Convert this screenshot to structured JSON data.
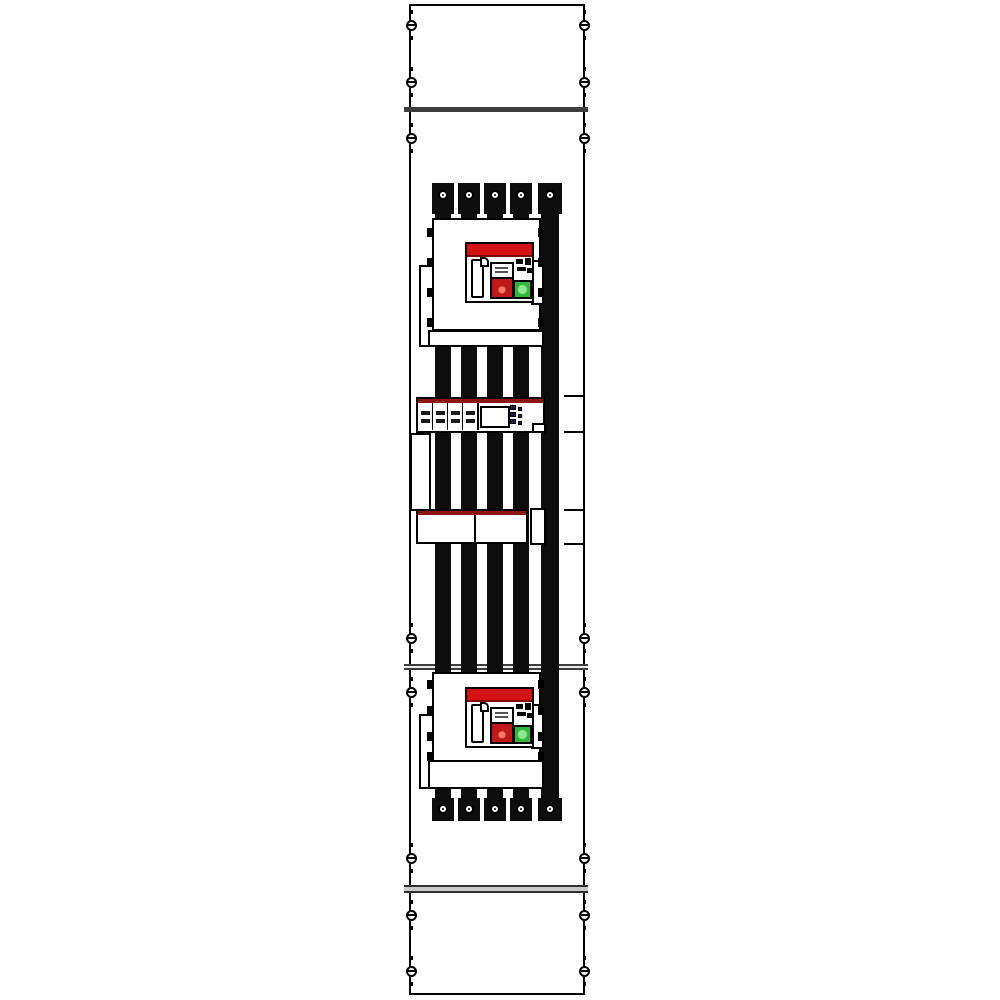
{
  "colors": {
    "c-outline": "#000000",
    "c-panel-bg": "#ffffff",
    "c-busbar": "#0d0d0d",
    "c-red-bar": "#d41414",
    "c-red-bar-edge": "#7d0a0a",
    "c-toggle-red": "#c01818",
    "c-toggle-red-hi": "#ef7d66",
    "c-green": "#2eb83c",
    "c-green-hi": "#8ee88e",
    "c-strip-red": "#8c1414",
    "c-navy": "#1c1c5a",
    "c-divider": "#3d3d3d",
    "c-divider-light": "#c9c9c9"
  },
  "panel": {
    "sections": [
      {
        "name": "top-cover"
      },
      {
        "name": "main-device-field"
      },
      {
        "name": "lower-device-field"
      },
      {
        "name": "bottom-cover"
      }
    ],
    "dividers_y": [
      107,
      664,
      885
    ]
  },
  "screws": {
    "cols_x": [
      411,
      584
    ],
    "rows_y": [
      25,
      82,
      138,
      638,
      692,
      858,
      915,
      971
    ]
  },
  "busbars": {
    "count": 5,
    "top": 190,
    "bottom": 810,
    "bars": [
      {
        "x": 435,
        "w": 16
      },
      {
        "x": 461,
        "w": 16
      },
      {
        "x": 487,
        "w": 16
      },
      {
        "x": 513,
        "w": 16
      },
      {
        "x": 541,
        "w": 18
      }
    ],
    "terminal_rows": [
      {
        "y": 183,
        "h": 31,
        "screw_y": 195
      },
      {
        "y": 798,
        "h": 23,
        "screw_y": 809
      }
    ]
  },
  "breakers": [
    {
      "id": "upper-breaker",
      "clip_ys": [
        228,
        258,
        288,
        318
      ]
    },
    {
      "id": "lower-breaker",
      "clip_ys": [
        680,
        706,
        732,
        752
      ]
    }
  ],
  "meter": {
    "module_count": 4,
    "dot_columns": [
      {
        "x": 510,
        "w": 6,
        "h": 5,
        "ys": [
          405,
          412,
          419
        ]
      },
      {
        "x": 518,
        "w": 4,
        "h": 4,
        "ys": [
          407,
          414,
          421
        ]
      }
    ]
  },
  "right_ticks_y": [
    395,
    431,
    509,
    543
  ]
}
